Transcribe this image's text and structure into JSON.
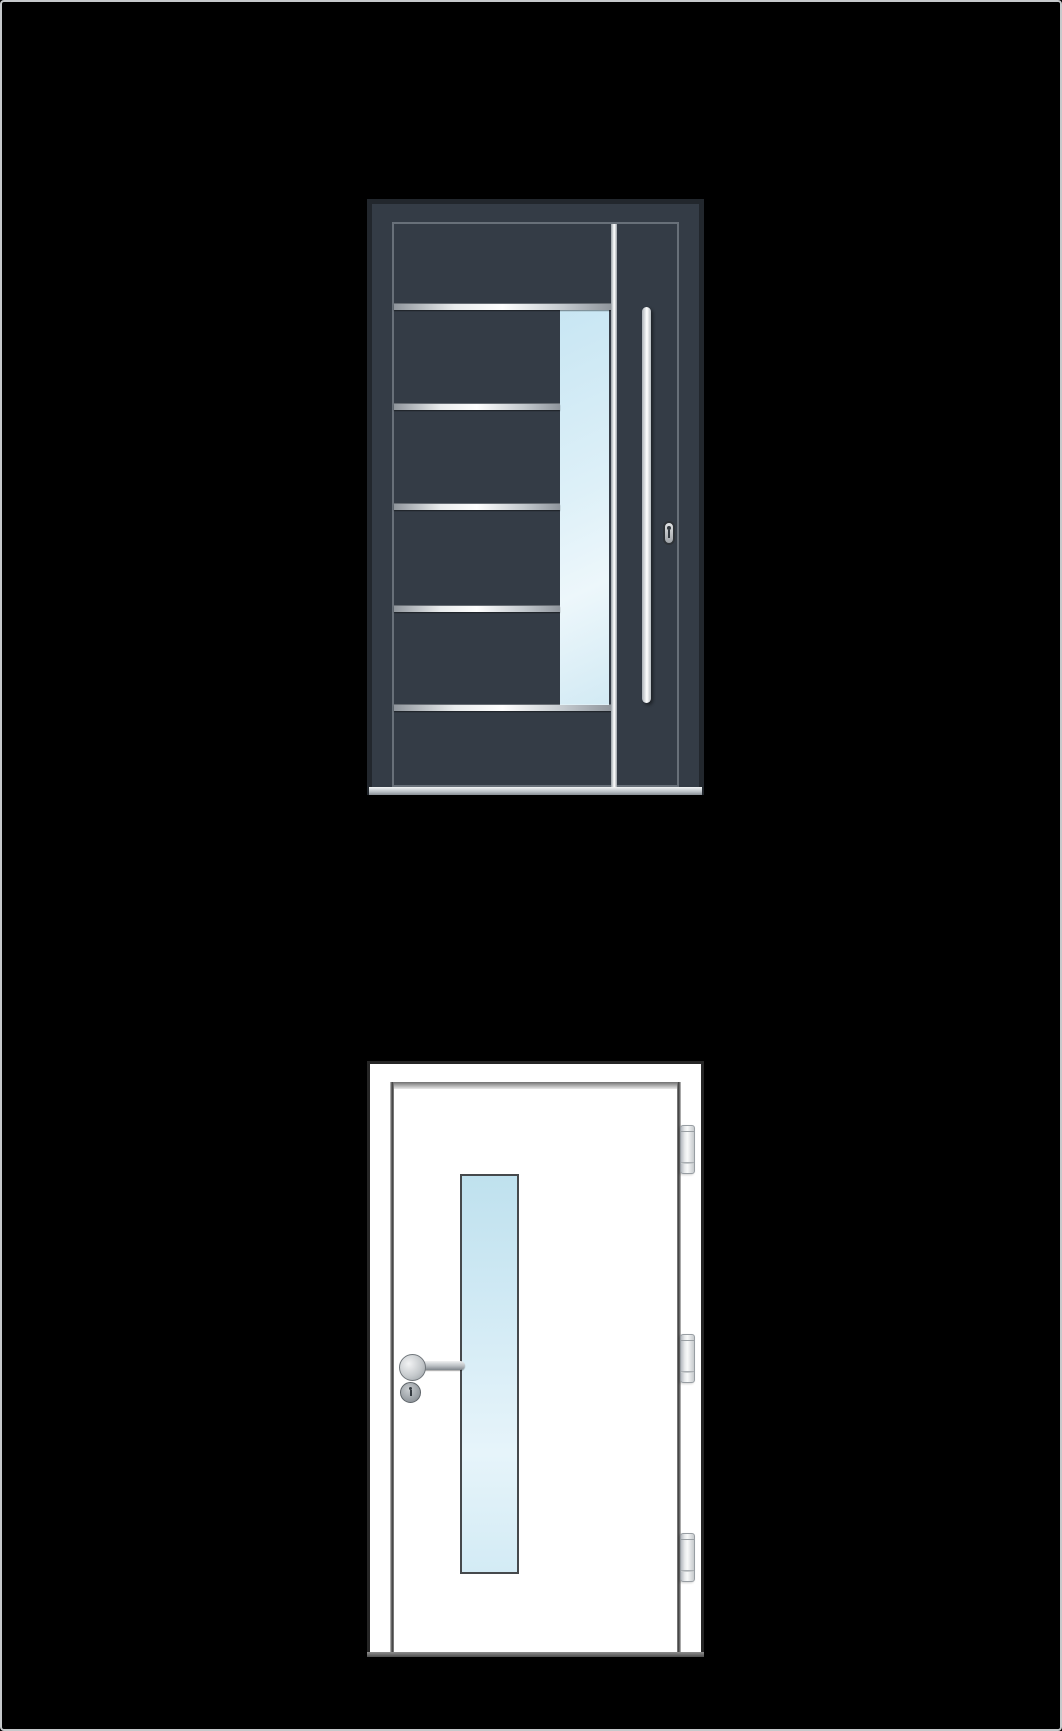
{
  "colors": {
    "background": "#000000",
    "page-border": "#c6c9cb",
    "anthracite-frame": "#343c46",
    "anthracite-edge": "#22272d",
    "leaf-outline-light": "#767d86",
    "silver-light": "#ffffff",
    "silver-mid": "#c3c9ce",
    "silver-dark": "#8f959c",
    "glass-blue": "#c8e6f3",
    "glass-blue-light": "#edf7fb",
    "white-door": "#ffffff",
    "door-outline-dark": "#262626",
    "hinge-border": "#989ea3",
    "keyhole-dark": "#343a40"
  },
  "doors": {
    "entrance_door": {
      "name": "Anthracite entrance door with five horizontal steel stripes, vertical glass stripe, full-height bar handle and lock cylinder",
      "stripe_count": 5,
      "glazing": "vertical glass stripe",
      "hardware": [
        "bar-handle",
        "lock-cylinder"
      ]
    },
    "interior_door": {
      "name": "White interior door with vertical glazing, lever handle, cylinder escutcheon and three hinges",
      "hinge_count": 3,
      "glazing": "vertical glass panel",
      "hardware": [
        "lever-handle",
        "rosette",
        "cylinder-escutcheon",
        "hinges"
      ]
    }
  }
}
